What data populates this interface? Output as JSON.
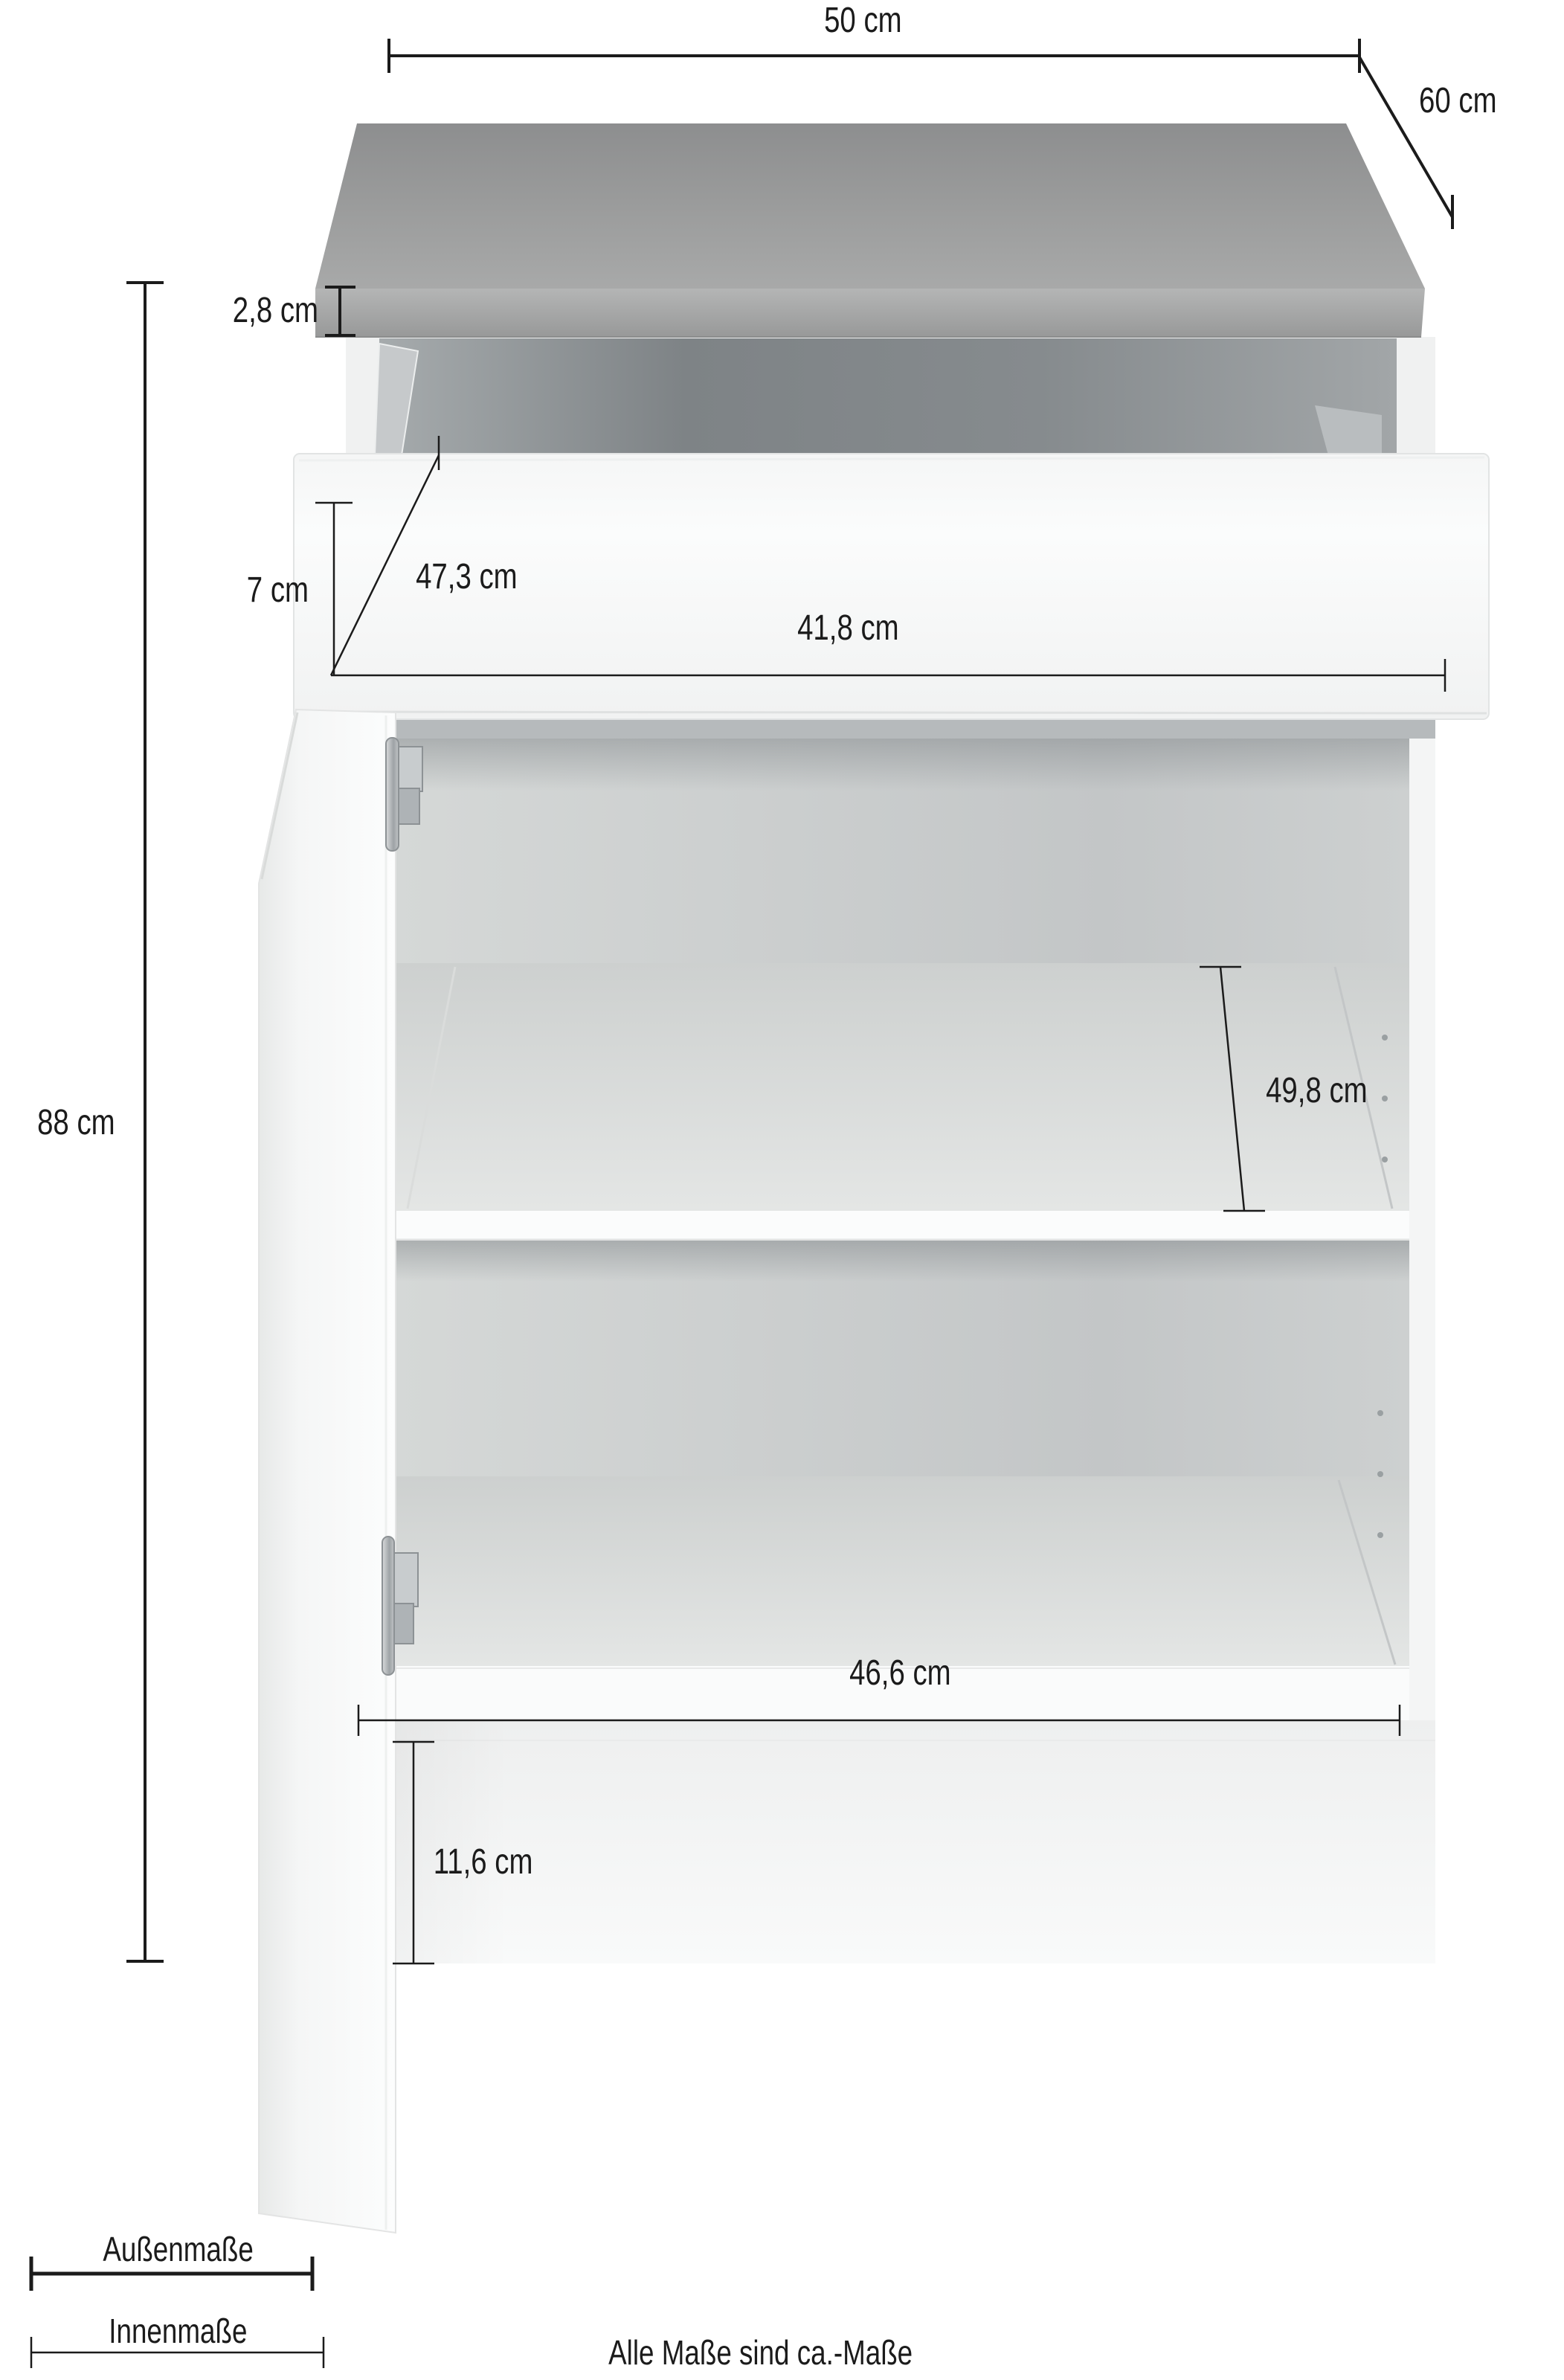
{
  "diagram": {
    "subject": "kitchen-base-cabinet-dimension-drawing",
    "dim_labels": {
      "top_width": "50 cm",
      "depth": "60 cm",
      "worktop_thickness": "2,8 cm",
      "drawer_front_height": "7 cm",
      "drawer_inner_depth": "47,3 cm",
      "drawer_inner_width": "41,8 cm",
      "total_height": "88 cm",
      "inner_depth": "49,8 cm",
      "inner_width": "46,6 cm",
      "plinth_height": "11,6 cm"
    },
    "legend": {
      "outer_label": "Außenmaße",
      "inner_label": "Innenmaße"
    },
    "footer_note": "Alle Maße sind ca.-Maße",
    "colors": {
      "worktop_gray": "#9c9d9d",
      "carcass_white": "#f5f6f6",
      "interior_gray": "#cbcecf",
      "dimension_line": "#1b1b1b"
    }
  }
}
